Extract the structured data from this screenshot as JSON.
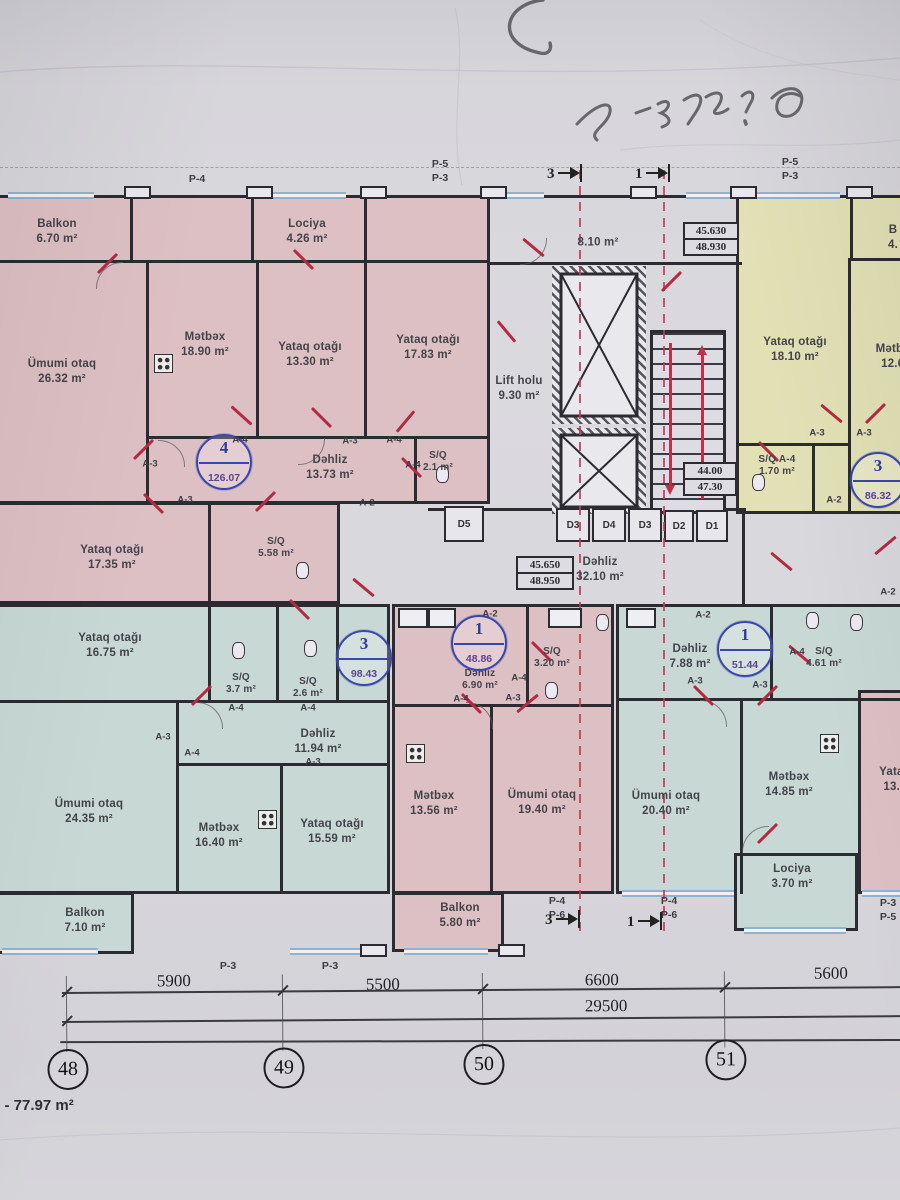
{
  "annotations": {
    "handwriting": "Qius-8",
    "corner_area": "ə - 77.97 m²"
  },
  "units": {
    "nw": {
      "number": "4",
      "area": "126.07"
    },
    "ne": {
      "number": "3",
      "area": "86.32"
    },
    "sw": {
      "number": "3",
      "area": "98.43"
    },
    "sm": {
      "number": "1",
      "area": "48.86"
    },
    "se": {
      "number": "1",
      "area": "51.44"
    }
  },
  "rooms": {
    "balkon_nw": {
      "name": "Balkon",
      "area": "6.70 m²"
    },
    "umumi_nw": {
      "name": "Ümumi otaq",
      "area": "26.32 m²"
    },
    "metbex_nw": {
      "name": "Mətbəx",
      "area": "18.90 m²"
    },
    "lociya_nw": {
      "name": "Lociya",
      "area": "4.26 m²"
    },
    "yataq_nw_a": {
      "name": "Yataq otağı",
      "area": "13.30 m²"
    },
    "yataq_nw_b": {
      "name": "Yataq otağı",
      "area": "17.83 m²"
    },
    "dehliz_nw": {
      "name": "Dəhliz",
      "area": "13.73 m²"
    },
    "sq_nw": {
      "name": "S/Q",
      "area": "2.1 m²"
    },
    "yataq_nw_c": {
      "name": "Yataq otağı",
      "area": "17.35 m²"
    },
    "sq_nw_b": {
      "name": "S/Q",
      "area": "5.58 m²"
    },
    "corridor_top": {
      "name": "",
      "area": "8.10 m²"
    },
    "lift_holu": {
      "name": "Lift holu",
      "area": "9.30 m²"
    },
    "dehliz_core": {
      "name": "Dəhliz",
      "area": "32.10 m²"
    },
    "yataq_ne": {
      "name": "Yataq otağı",
      "area": "18.10 m²"
    },
    "metbex_ne": {
      "name": "Mətbəx",
      "area": "12.60"
    },
    "balkon_ne": {
      "name": "B",
      "area": "4."
    },
    "sq_ne": {
      "name": "S/Q A-4",
      "area": "1.70 m²"
    },
    "yataq_sw": {
      "name": "Yataq otağı",
      "area": "16.75 m²"
    },
    "sq_sw_a": {
      "name": "S/Q",
      "area": "3.7 m²"
    },
    "sq_sw_b": {
      "name": "S/Q",
      "area": "2.6 m²"
    },
    "dehliz_sw": {
      "name": "Dəhliz",
      "area": "11.94 m²"
    },
    "umumi_sw": {
      "name": "Ümumi otaq",
      "area": "24.35 m²"
    },
    "metbex_sw": {
      "name": "Mətbəx",
      "area": "16.40 m²"
    },
    "yataq_sw_b": {
      "name": "Yataq otağı",
      "area": "15.59 m²"
    },
    "balkon_sw": {
      "name": "Balkon",
      "area": "7.10 m²"
    },
    "dehliz_sm": {
      "name": "Dəhliz",
      "area": "6.90 m²"
    },
    "sq_sm": {
      "name": "S/Q",
      "area": "3.20 m²"
    },
    "metbex_sm": {
      "name": "Mətbəx",
      "area": "13.56 m²"
    },
    "umumi_sm": {
      "name": "Ümumi otaq",
      "area": "19.40 m²"
    },
    "balkon_sm": {
      "name": "Balkon",
      "area": "5.80 m²"
    },
    "dehliz_se": {
      "name": "Dəhliz",
      "area": "7.88 m²"
    },
    "sq_se": {
      "name": "S/Q",
      "area": "4.61 m²"
    },
    "umumi_se": {
      "name": "Ümumi otaq",
      "area": "20.40 m²"
    },
    "metbex_se": {
      "name": "Mətbəx",
      "area": "14.85 m²"
    },
    "lociya_se": {
      "name": "Lociya",
      "area": "3.70 m²"
    },
    "yataq_e": {
      "name": "Yataq",
      "area": "13.6"
    }
  },
  "elevations": {
    "ne": {
      "upper": "45.630",
      "lower": "48.930"
    },
    "stair": {
      "upper": "44.00",
      "lower": "47.30"
    },
    "mid": {
      "upper": "45.650",
      "lower": "48.950"
    }
  },
  "ducts": {
    "d1": "D1",
    "d2": "D2",
    "d3": "D3",
    "d4": "D4",
    "d5": "D5"
  },
  "doors": {
    "a2": "A-2",
    "a3": "A-3",
    "a4": "A-4"
  },
  "plabels": {
    "p3": "P-3",
    "p4": "P-4",
    "p5": "P-5",
    "p6": "P-6"
  },
  "markers": {
    "m1": "1",
    "m3": "3"
  },
  "dims": {
    "d5900": "5900",
    "d5500": "5500",
    "d6600": "6600",
    "d5600": "5600",
    "total": "29500"
  },
  "grid": {
    "g48": "48",
    "g49": "49",
    "g50": "50",
    "g51": "51"
  },
  "colors": {
    "wall": "#2b2b31",
    "pink": "#ddc0c4",
    "yellow": "#e2e1b6",
    "teal": "#c8d9d5",
    "red_accent": "#b32b42",
    "badge_blue": "#3a47a8"
  }
}
